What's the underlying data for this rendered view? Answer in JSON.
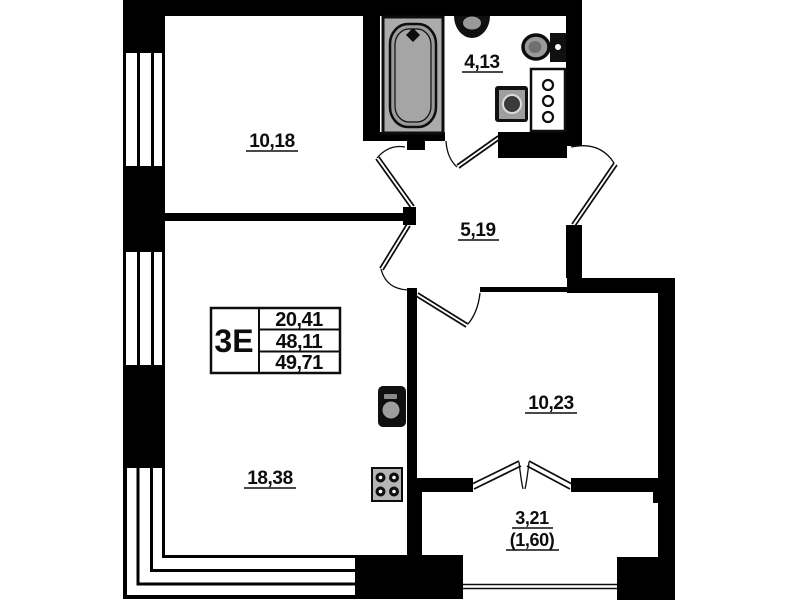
{
  "stamp": {
    "type_label": "3Е",
    "values": [
      "20,41",
      "48,11",
      "49,71"
    ]
  },
  "rooms": {
    "bedroom_top": {
      "area": "10,18"
    },
    "bathroom": {
      "area": "4,13"
    },
    "hallway": {
      "area": "5,19"
    },
    "kitchen_living": {
      "area": "18,38"
    },
    "bedroom_right": {
      "area": "10,23"
    },
    "balcony": {
      "area": "3,21",
      "area_weighted": "(1,60)"
    }
  },
  "fixtures": [
    "bathtub",
    "wash-basin",
    "toilet",
    "washing-machine",
    "bathroom-cabinet",
    "kitchen-sink",
    "stove"
  ],
  "palette": {
    "walls": "#000000",
    "background": "#ffffff",
    "fixtures_gray": "#9a9a9a"
  }
}
